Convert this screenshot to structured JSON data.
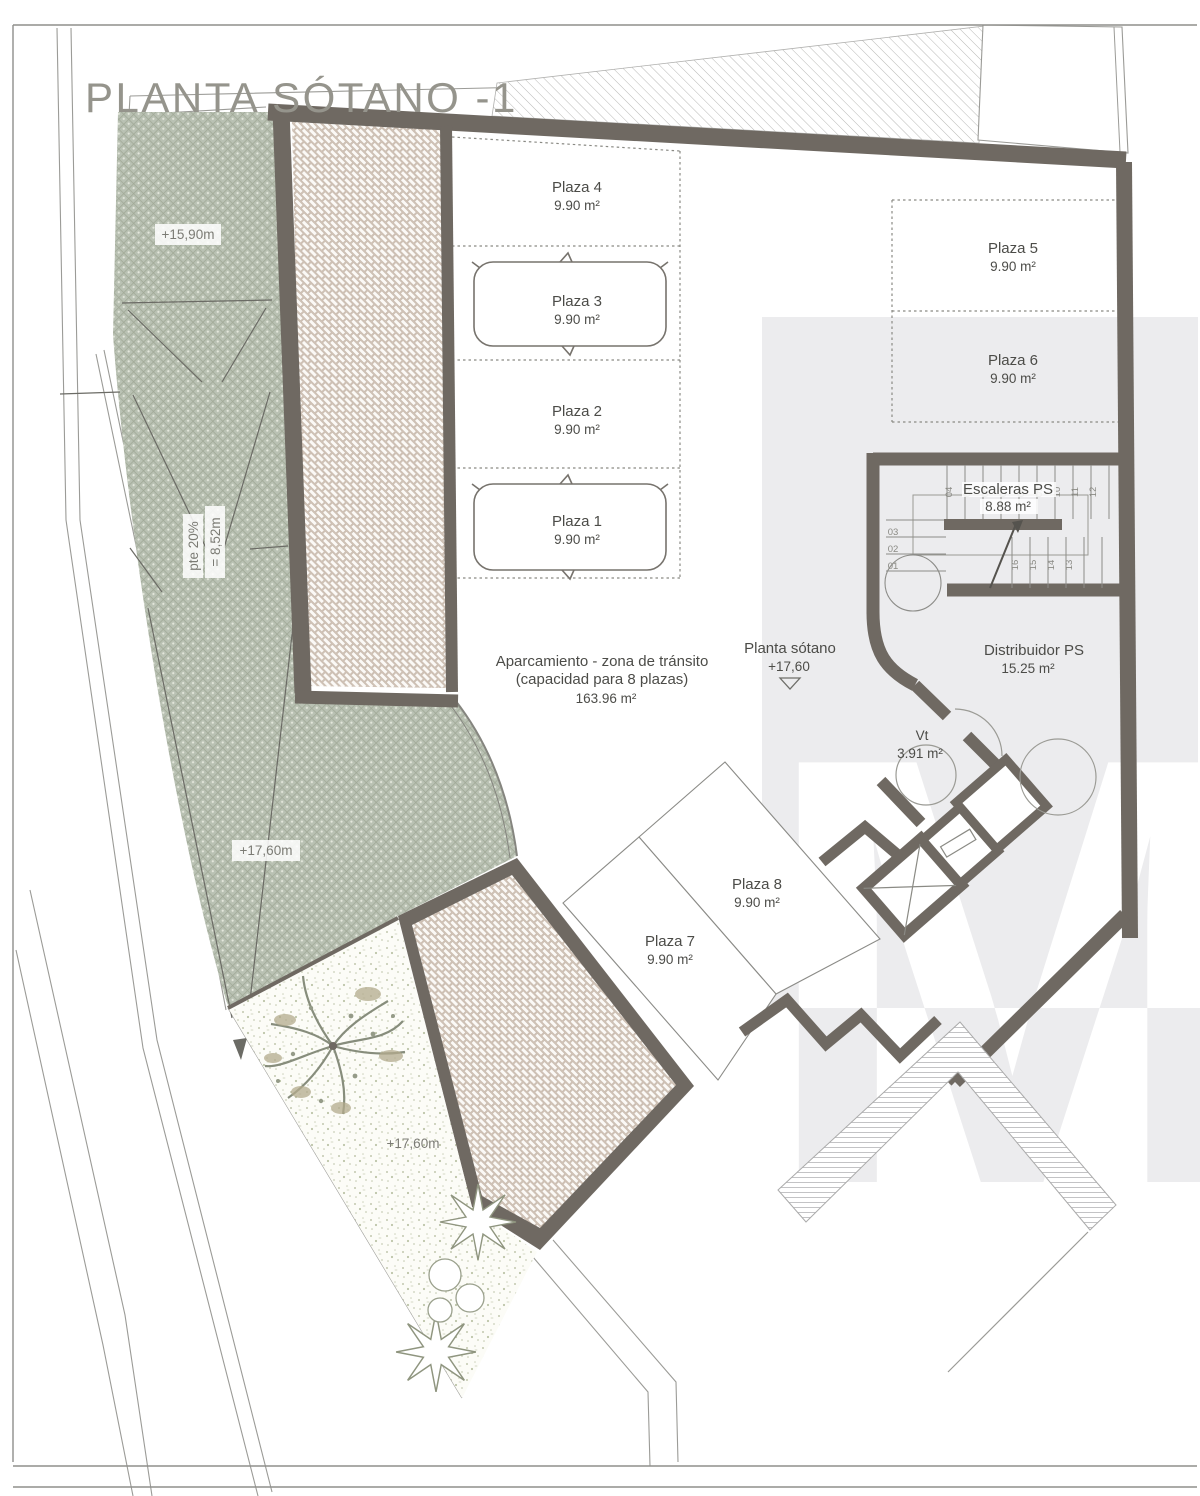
{
  "title": "PLANTA SÓTANO -1",
  "watermark": {
    "letter": "M"
  },
  "colors": {
    "wall": "#6f6962",
    "thin_line": "#9b9b97",
    "label_text": "#4c4c48",
    "title_text": "#95948c",
    "crosshatch_base": "#b9c1b3",
    "herringbone_base": "#d9cdc2",
    "watermark_gray": "#ececee"
  },
  "parking": {
    "spaces": [
      {
        "name": "Plaza 1",
        "area": "9.90 m²"
      },
      {
        "name": "Plaza 2",
        "area": "9.90 m²"
      },
      {
        "name": "Plaza 3",
        "area": "9.90 m²"
      },
      {
        "name": "Plaza 4",
        "area": "9.90 m²"
      },
      {
        "name": "Plaza 5",
        "area": "9.90 m²"
      },
      {
        "name": "Plaza 6",
        "area": "9.90 m²"
      },
      {
        "name": "Plaza 7",
        "area": "9.90 m²"
      },
      {
        "name": "Plaza 8",
        "area": "9.90 m²"
      }
    ]
  },
  "zone": {
    "line1": "Aparcamiento - zona de tránsito",
    "line2": "(capacidad para 8 plazas)",
    "line3": "163.96 m²"
  },
  "level_marker": {
    "line1": "Planta sótano",
    "line2": "+17,60"
  },
  "rooms": {
    "distribuidor": {
      "name": "Distribuidor PS",
      "area": "15.25 m²"
    },
    "escaleras": {
      "name": "Escaleras PS",
      "area": "8.88 m²"
    },
    "vestibulo": {
      "name": "Vt",
      "area": "3.91 m²"
    }
  },
  "elevations": {
    "ramp_top": "+15,90m",
    "ramp_mid": "+17,60m",
    "garden": "+17,60m"
  },
  "ramp": {
    "length": "= 8,52m",
    "slope": "pte 20%"
  },
  "stairs": {
    "steps": [
      "01",
      "02",
      "03",
      "04",
      "05",
      "06",
      "07",
      "08",
      "09",
      "10",
      "11",
      "12",
      "13",
      "14",
      "15",
      "16"
    ]
  }
}
